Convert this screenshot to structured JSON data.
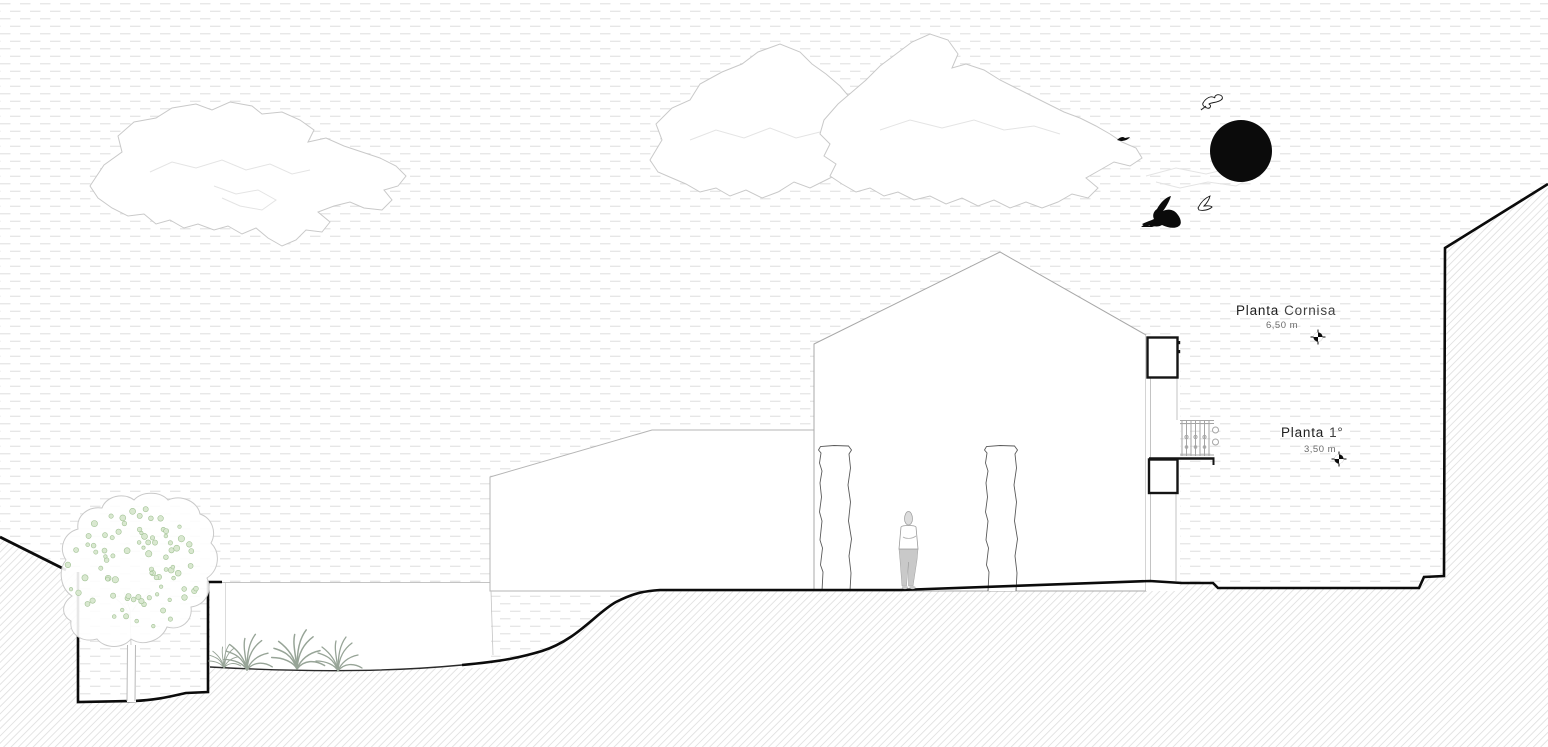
{
  "scene": {
    "kind": "architectural cross-section / elevation drawing"
  },
  "annotations": {
    "cornice": {
      "name": "Planta",
      "qualifier": "Cornisa",
      "height": "6,50 m"
    },
    "first_floor": {
      "name": "Planta",
      "qualifier": "1°",
      "height": "3,50 m"
    }
  },
  "icons": {
    "sun": "sun-icon",
    "level_marker": "level-benchmark-icon",
    "birds": [
      "gull-outline-icon",
      "bird-silhouette-icon",
      "gull-outline-icon",
      "bird-small-silhouette-icon"
    ]
  },
  "colors": {
    "ink": "#0b0b0b",
    "outline_light": "#c9c9c9",
    "outline_mid": "#9a9a9a",
    "sky_dash": "#e2e2e2",
    "earth_hatch": "#e0e0e0",
    "foliage_fill": "#d9e8d0",
    "foliage_stroke": "#a2c295",
    "grass": "#97a497",
    "figure_pants": "#c9c9c9",
    "text_dark": "#1e1e1e",
    "text_muted": "#6b6b6b"
  }
}
